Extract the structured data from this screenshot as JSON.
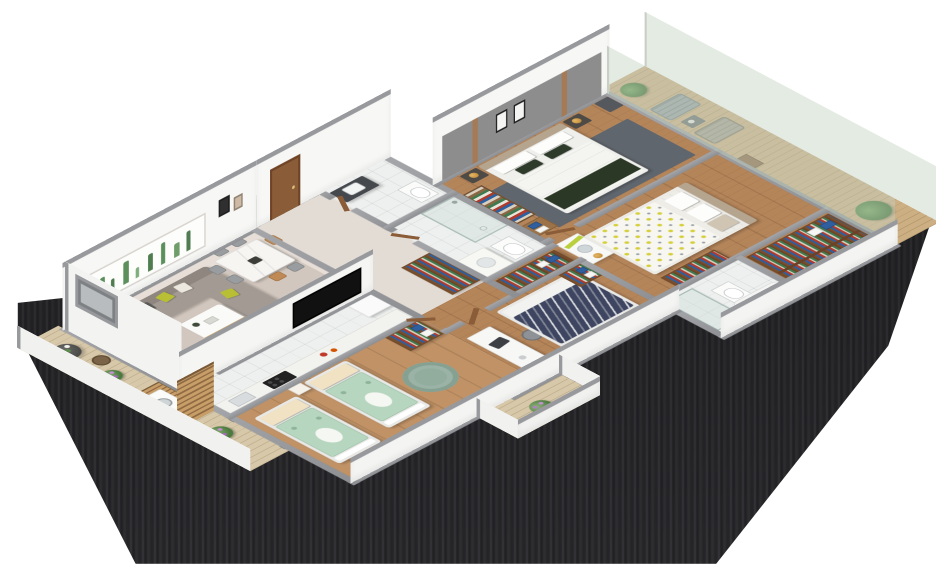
{
  "meta": {
    "title": "3D isometric apartment floor plan",
    "description": "Photorealistic cutaway 3D floor plan render of a three-bedroom apartment with balconies on a white background, with a dark streaked ground shadow",
    "background": "#ffffff",
    "view": "isometric cutaway from above"
  },
  "palette": {
    "wall_cap": "#97999d",
    "wall_face": "#f7f7f5",
    "wood_floor": "#b5855a",
    "tile_floor": "#eef0ef",
    "deck_wood": "#d7c8a9",
    "glass_railing": "rgba(196,210,194,0.45)",
    "sofa_gray": "#a29a93",
    "accent_chartreuse": "#b9bf35",
    "dark_green_bedding": "#2c3826",
    "mint_blanket": "#b7d6bf",
    "navy_blanket": "#3d4560",
    "towel_blue": "#2f5f9e",
    "door_wood": "#8a5c38",
    "shadow_dark": "#2a2a2c"
  },
  "rooms": {
    "living_room": {
      "label": "Living room",
      "floor": "beige carpet with rug"
    },
    "dining_area": {
      "label": "Dining area",
      "floor": "beige carpet"
    },
    "kitchen": {
      "label": "Galley kitchen",
      "floor": "white tile"
    },
    "kids_bedroom": {
      "label": "Kids bedroom with twin beds",
      "floor": "wood"
    },
    "bedroom_desk": {
      "label": "Bedroom with desk and navy bed",
      "floor": "wood"
    },
    "master_bedroom": {
      "label": "Master bedroom",
      "floor": "wood"
    },
    "bedroom_guest": {
      "label": "Second bedroom with lemon-print bed",
      "floor": "wood"
    },
    "entry": {
      "label": "Entry hall",
      "floor": "beige tile"
    },
    "hallway": {
      "label": "Hallway corridor",
      "floor": "wood"
    },
    "bath_guest": {
      "label": "Guest bathroom with dark vanity",
      "floor": "white tile"
    },
    "bath_shower": {
      "label": "Shower bathroom",
      "floor": "white tile"
    },
    "bath_tub": {
      "label": "Bathroom with bathtub and shower",
      "floor": "white tile"
    },
    "closet": {
      "label": "Storage / walk-in closet",
      "floor": "wood"
    },
    "balcony_living": {
      "label": "Living room balcony with laundry nook",
      "floor": "wood deck"
    },
    "balcony_master": {
      "label": "Long balcony with glass railing",
      "floor": "wood deck"
    },
    "balcony_bottom": {
      "label": "Small lower balcony",
      "floor": "wood deck"
    },
    "entry_niche": {
      "label": "Entry vestibule / duct shaft",
      "floor": "dark gray slab"
    }
  },
  "furniture": {
    "sofa": "L-shaped gray sectional sofa with chartreuse and patterned pillows",
    "wall_art": "Long cactus-print wall art panel",
    "gallery_frames": "Framed artwork pair",
    "coffee_table": "White coffee table with wood shelf",
    "tv": "Wall-mounted flat screen TV",
    "dining_table": "White marble dining table",
    "dining_chairs": "Six dining chairs, gray and tan",
    "balcony_table": "Round granite bistro table with plates",
    "wicker_chairs": "Wicker balcony chairs",
    "flower_pot": "Potted plant with purple flowers",
    "washing_machine": "Front-load washing machine",
    "slat_screen": "Wooden slat laundry screen",
    "kitchen_counter": "White kitchen counter",
    "cooktop": "Black four-burner cooktop",
    "kitchen_sink": "Kitchen sink",
    "fridge": "White refrigerator cabinet",
    "twin_bed": "Twin bed with mint Totoro blanket and cream pillow",
    "kids_nightstand": "Kids nightstand",
    "round_rug": "Round sage-green rug",
    "kids_wardrobe": "Wood wardrobe with books and blue towels",
    "desk": "White desk with laptop",
    "desk_chair": "Gray office chair",
    "navy_bed": "Double bed with navy chevron blanket",
    "hall_shelf": "Hallway bookshelf",
    "dark_vanity": "Dark bathroom vanity with sink and mirror",
    "toilet": "Toilet",
    "shower": "Glass shower enclosure",
    "white_vanity": "White bathroom vanity with basin",
    "bathtub": "Bathtub",
    "master_bed": "King bed with white duvet and dark green runner",
    "headboard_panel": "Gray upholstered headboard wall with wood strips and framed art",
    "nightstand": "Dark nightstand with brass lamp",
    "master_wardrobe": "Open wardrobe with clothes",
    "bench_towels": "Bench with folded blue towels",
    "master_rug": "Dark gray area rug",
    "dresser": "White dresser with green accents and mirror",
    "lemon_bed": "Double bed with lemon-print bedding",
    "bookshelf": "Low wood bookshelf",
    "closet_shelves": "Closet shelving with books and towels",
    "lounge_chair": "Balcony lounge chair",
    "balcony_side_table": "Balcony side table",
    "potted_plant": "Green potted plant",
    "glass_railing": "Frameless green-tinted glass balcony railing",
    "entry_door": "Wooden entry door",
    "interior_door": "Wooden interior door leaf"
  }
}
